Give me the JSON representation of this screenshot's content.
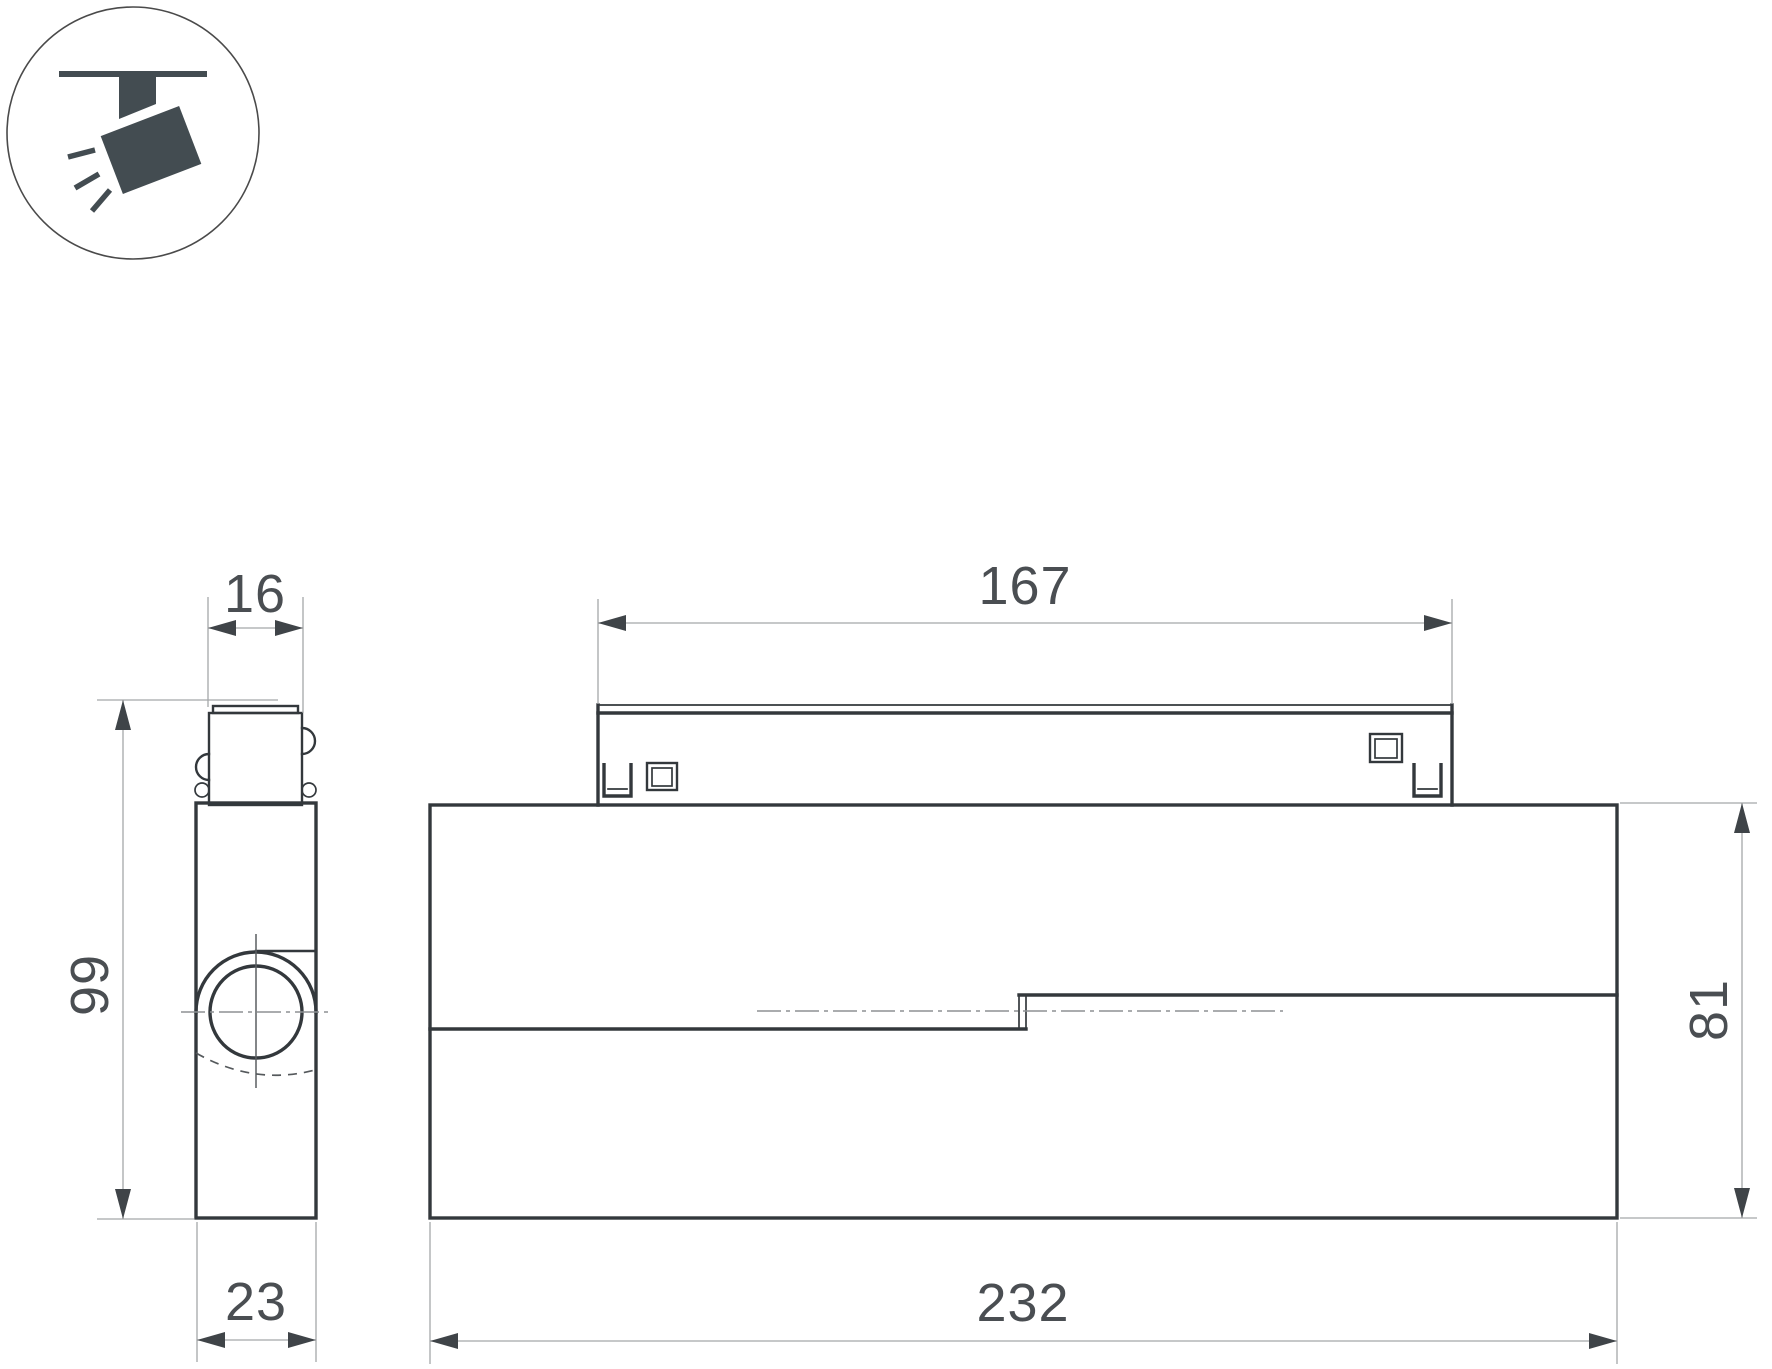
{
  "icon": {
    "label": "track-spotlight"
  },
  "side_view": {
    "width_top": "16",
    "height": "99",
    "width_bottom": "23"
  },
  "front_view": {
    "length_top": "167",
    "height": "81",
    "length_bottom": "232"
  },
  "colors": {
    "background": "#ffffff",
    "outline": "#33383c",
    "dim_line": "#a5a7a9",
    "arrow": "#3f4448",
    "text": "#4a4e52",
    "icon_fill": "#434c51"
  }
}
